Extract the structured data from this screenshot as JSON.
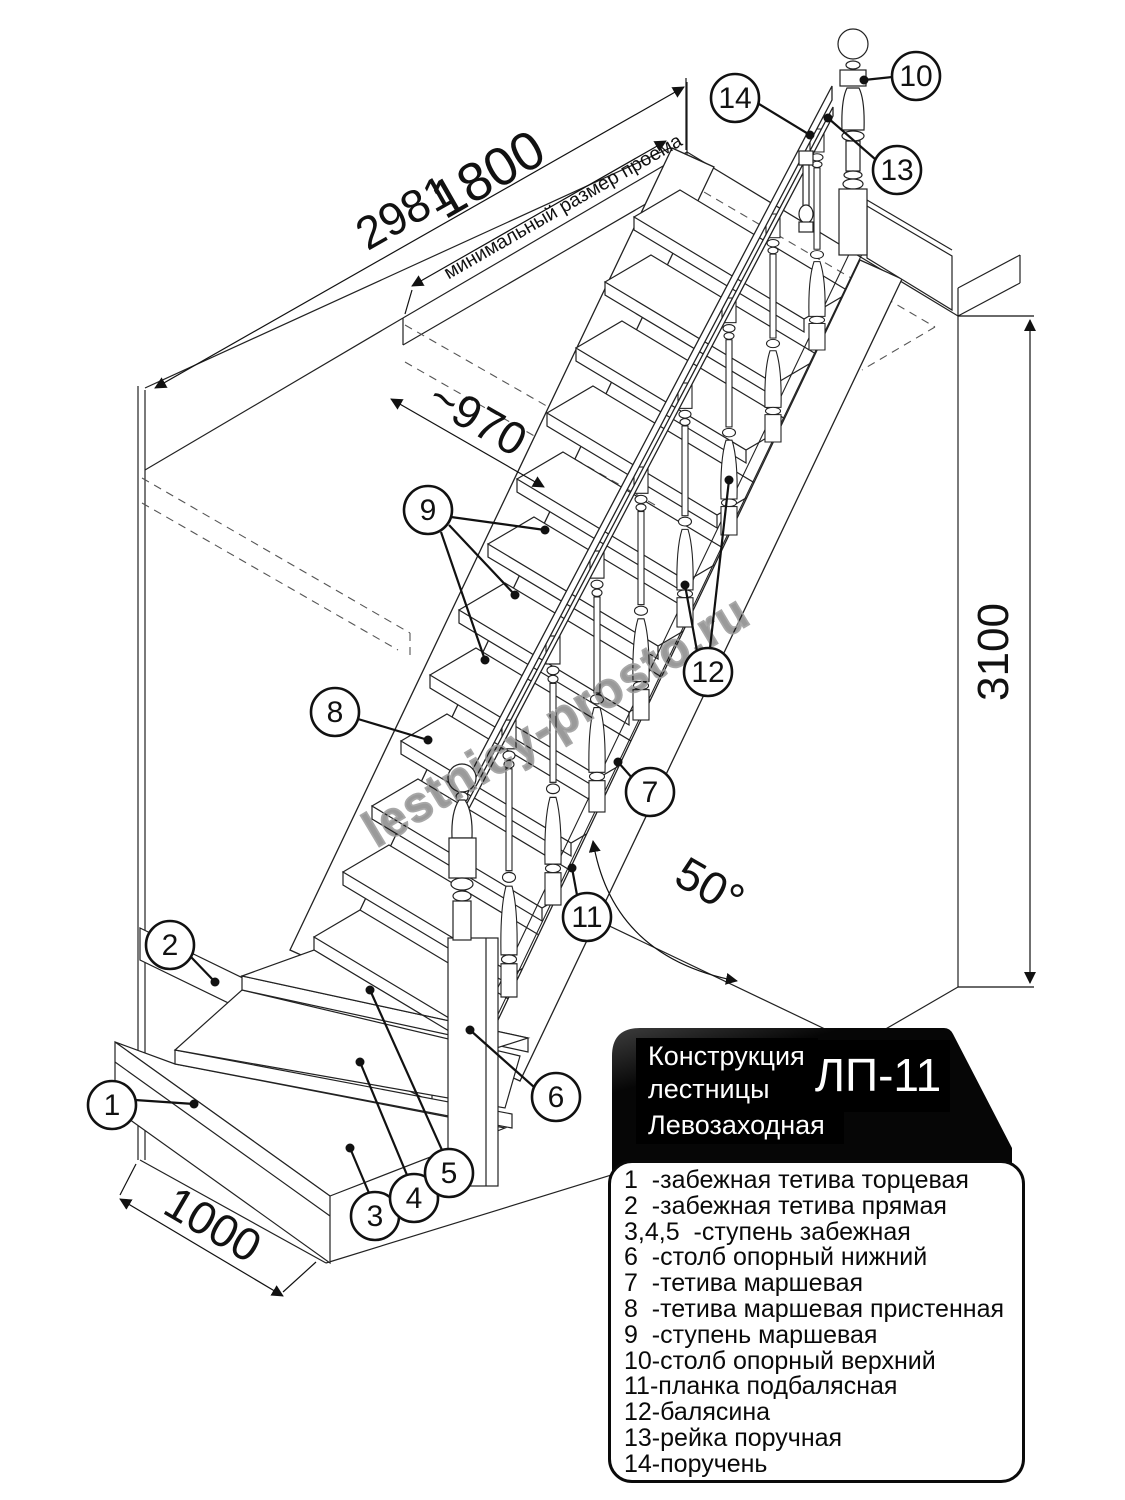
{
  "diagram": {
    "dims": {
      "d2981": "2981",
      "d1800": "1800",
      "opening_note": "минимальный размер проема",
      "d970": "~970",
      "d3100": "3100",
      "angle50": "50°",
      "d1000": "1000"
    },
    "callouts": [
      "1",
      "2",
      "3",
      "4",
      "5",
      "6",
      "7",
      "8",
      "9",
      "10",
      "11",
      "12",
      "13",
      "14"
    ],
    "watermark": "lestnicy-prosto.ru"
  },
  "legend": {
    "header": {
      "line1": "Конструкция",
      "line2": "лестницы",
      "line3": "Левозаходная",
      "model": "ЛП-11"
    },
    "items": [
      "1  -забежная тетива торцевая",
      "2  -забежная тетива прямая",
      "3,4,5  -ступень забежная",
      "6  -столб опорный нижний",
      "7  -тетива маршевая",
      "8  -тетива маршевая пристенная",
      "9  -ступень маршевая",
      "10-столб опорный верхний",
      "11-планка подбалясная",
      "12-балясина",
      "13-рейка поручная",
      "14-поручень"
    ]
  }
}
